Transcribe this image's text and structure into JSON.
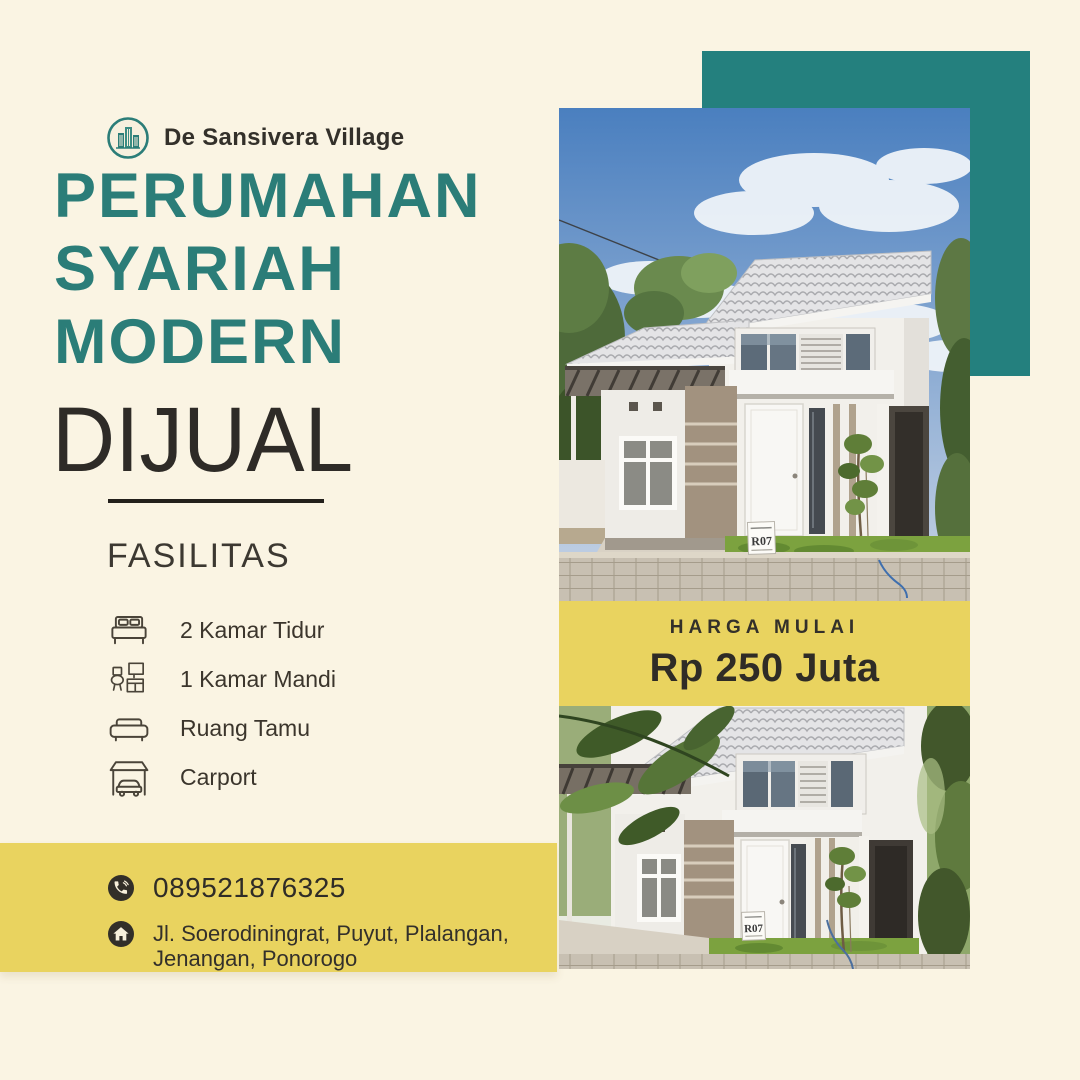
{
  "brand": {
    "name": "De Sansivera Village"
  },
  "headline": {
    "line1": "PERUMAHAN",
    "line2": "SYARIAH",
    "line3": "MODERN",
    "subline": "DIJUAL"
  },
  "facilities": {
    "title": "FASILITAS",
    "items": [
      {
        "icon": "bed-icon",
        "label": "2 Kamar Tidur"
      },
      {
        "icon": "bathroom-icon",
        "label": "1 Kamar Mandi"
      },
      {
        "icon": "sofa-icon",
        "label": "Ruang Tamu"
      },
      {
        "icon": "carport-icon",
        "label": "Carport"
      }
    ]
  },
  "price": {
    "label": "HARGA MULAI",
    "value": "Rp 250 Juta"
  },
  "contact": {
    "phone": "089521876325",
    "address_line1": "Jl. Soerodiningrat, Puyut, Plalangan,",
    "address_line2": "Jenangan, Ponorogo"
  },
  "photos": {
    "house_sign": "R07"
  },
  "colors": {
    "teal_heading": "#2b7d78",
    "teal_block": "#24807e",
    "yellow": "#e9d35f",
    "cream": "#faf4e3",
    "dark_text": "#302d27"
  }
}
